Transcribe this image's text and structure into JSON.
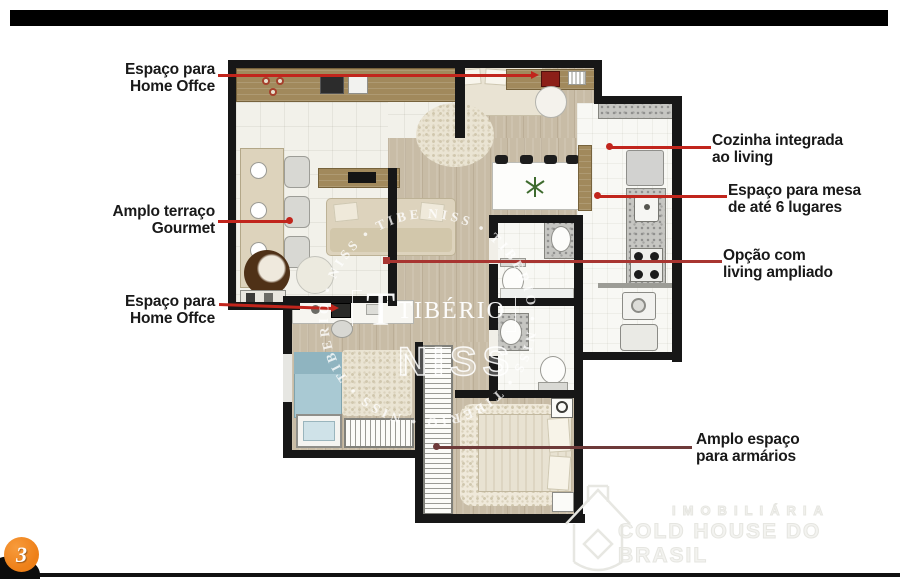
{
  "image": {
    "kind": "apartment floor plan marketing slide"
  },
  "colors": {
    "accent_red": "#c1251c",
    "red_mid": "#a83531",
    "red_dark": "#6e3a39",
    "wall": "#171717",
    "wood": "#c8bca6",
    "counter_brown": "#a1895c",
    "badge_orange": "#ee8018",
    "bed_blue": "#a9c9d3",
    "label_text": "#191919"
  },
  "callouts": {
    "home_office_top": {
      "line1": "Espaço para",
      "line2": "Home Offce"
    },
    "terraco": {
      "line1": "Amplo terraço",
      "line2": "Gourmet"
    },
    "home_office_bottom": {
      "line1": "Espaço para",
      "line2": "Home Offce"
    },
    "cozinha": {
      "line1": "Cozinha integrada",
      "line2": "ao living"
    },
    "mesa": {
      "line1": "Espaço para mesa",
      "line2": "de até 6 lugares"
    },
    "living": {
      "line1": "Opção com",
      "line2": "living ampliado"
    },
    "armarios": {
      "line1": "Amplo espaço",
      "line2": "para armários"
    }
  },
  "watermarks": {
    "brand_initial": "T",
    "brand": "TIBÉRIO",
    "brand_outline": "NISS",
    "ring_text": "NISS • TIBERIO • NISS • TIBERIO • NISS • TIBERIO • NISS • TIBERIO •",
    "agency_line1": "IMOBILIÁRIA",
    "agency_line2": "COLD HOUSE DO BRASIL"
  },
  "pagination": {
    "badge": "3"
  }
}
